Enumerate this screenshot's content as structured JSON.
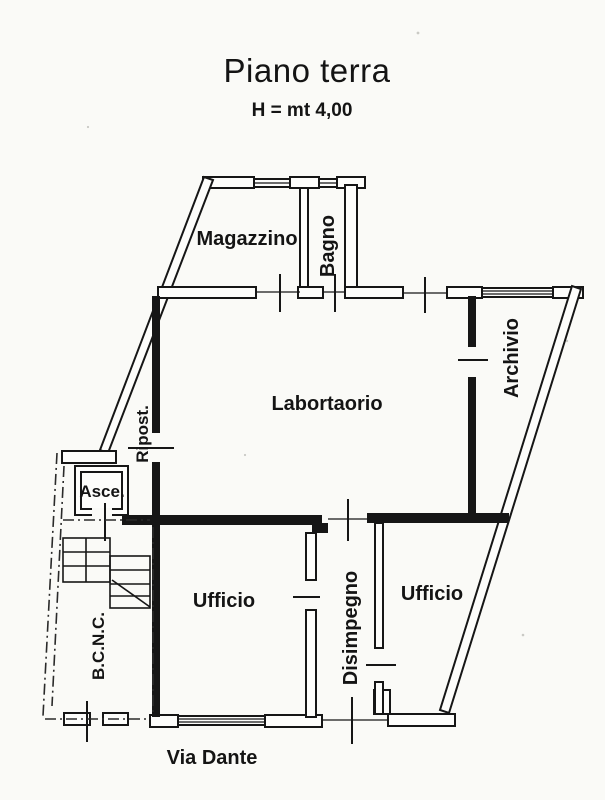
{
  "title": "Piano terra",
  "subtitle": "H = mt 4,00",
  "colors": {
    "ink": "#161616",
    "paper": "#fafaf7"
  },
  "rooms": {
    "magazzino": "Magazzino",
    "bagno": "Bagno",
    "laboratorio": "Labortaorio",
    "archivio": "Archivio",
    "ripostiglio": "Ripost.",
    "ascensore": "Asce.",
    "bcnc": "B.C.N.C.",
    "ufficio_sx": "Ufficio",
    "disimpegno": "Disimpegno",
    "ufficio_dx": "Ufficio",
    "street": "Via Dante"
  }
}
